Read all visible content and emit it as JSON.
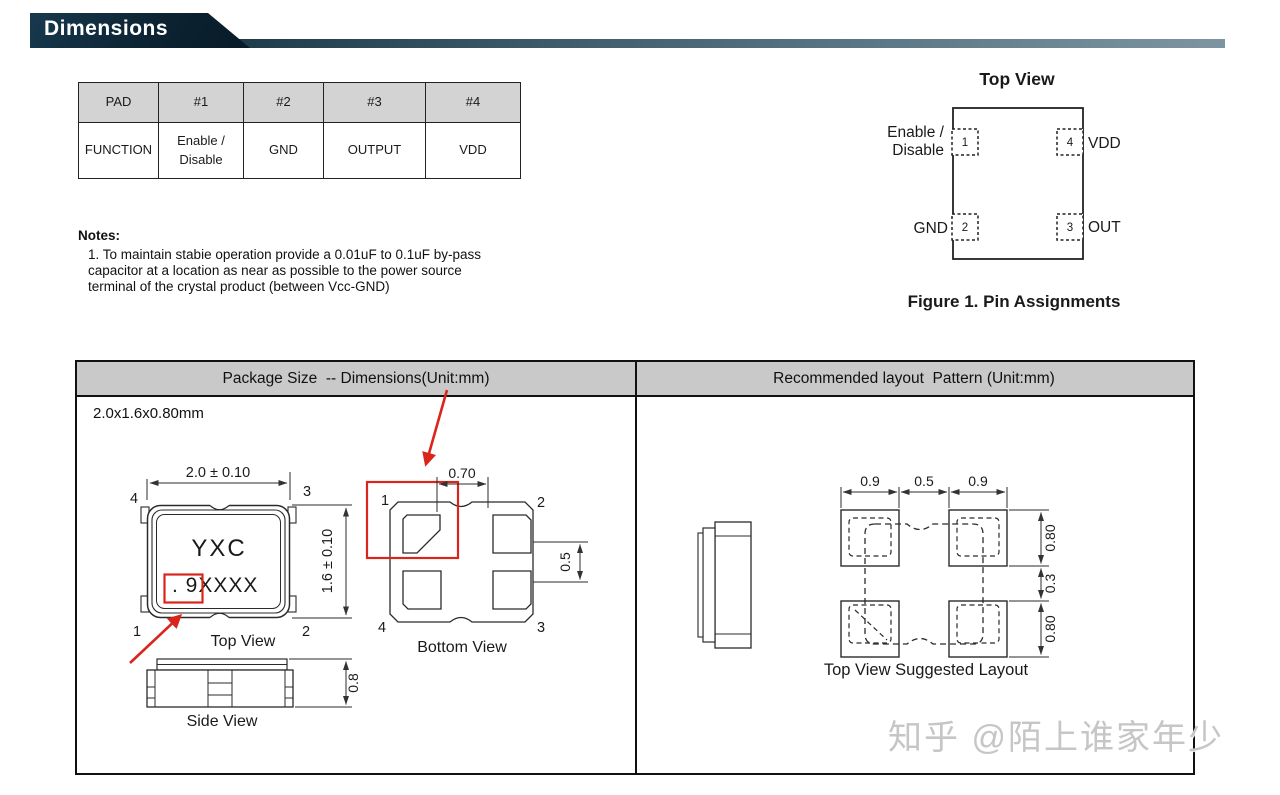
{
  "header": {
    "title": "Dimensions"
  },
  "pad_table": {
    "headers": [
      "PAD",
      "#1",
      "#2",
      "#3",
      "#4"
    ],
    "function_row": {
      "label": "FUNCTION",
      "pin1_line1": "Enable /",
      "pin1_line2": "Disable",
      "pin2": "GND",
      "pin3": "OUTPUT",
      "pin4": "VDD"
    }
  },
  "notes": {
    "heading": "Notes:",
    "lines": [
      "1. To maintain stabie operation provide a 0.01uF to 0.1uF by-pass",
      "capacitor at a location as near as possible to the power source",
      "terminal of the crystal product (between Vcc-GND)"
    ]
  },
  "pin_figure": {
    "title": "Top View",
    "caption": "Figure 1. Pin Assignments",
    "pin1": {
      "num": "1",
      "label_line1": "Enable /",
      "label_line2": "Disable"
    },
    "pin2": {
      "num": "2",
      "label": "GND"
    },
    "pin3": {
      "num": "3",
      "label": "OUT"
    },
    "pin4": {
      "num": "4",
      "label": "VDD"
    }
  },
  "dim_table": {
    "left_header": "Package Size  -- Dimensions(Unit:mm)",
    "right_header": "Recommended layout  Pattern (Unit:mm)",
    "size_label": "2.0x1.6x0.80mm",
    "top_view": {
      "caption": "Top View",
      "dim_width": "2.0 ± 0.10",
      "dim_height": "1.6 ± 0.10",
      "marking_line1": "YXC",
      "marking_line2": ". 9XXXX",
      "pin_tl": "4",
      "pin_tr": "3",
      "pin_bl": "1",
      "pin_br": "2"
    },
    "bottom_view": {
      "caption": "Bottom View",
      "dim_top": "0.70",
      "dim_right": "0.5",
      "pin_tl": "1",
      "pin_tr": "2",
      "pin_bl": "4",
      "pin_br": "3"
    },
    "side_view": {
      "caption": "Side View",
      "dim_height": "0.8"
    },
    "layout": {
      "caption": "Top View Suggested Layout",
      "dim_top_left": "0.9",
      "dim_top_mid": "0.5",
      "dim_top_right": "0.9",
      "dim_right_top": "0.80",
      "dim_right_mid": "0.3",
      "dim_right_bottom": "0.80"
    }
  },
  "watermark": "知乎 @陌上谁家年少"
}
